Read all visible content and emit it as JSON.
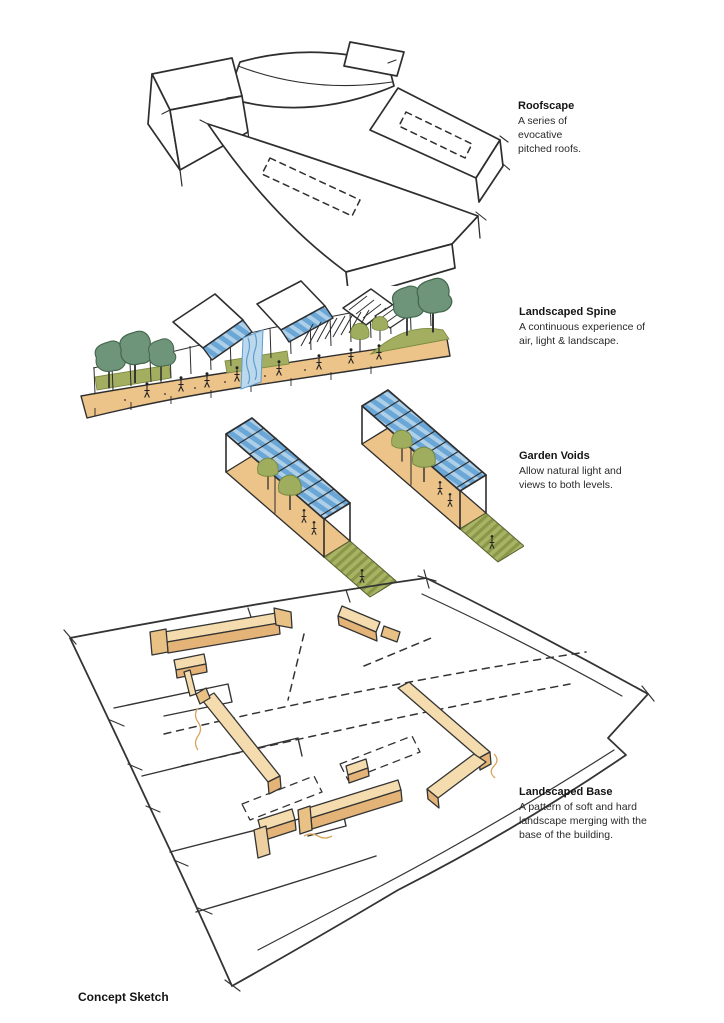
{
  "page": {
    "background": "#ffffff",
    "caption": "Concept Sketch"
  },
  "annotations": [
    {
      "id": "roofscape",
      "title": "Roofscape",
      "description": "A series of evocative pitched roofs."
    },
    {
      "id": "landscaped-spine",
      "title": "Landscaped Spine",
      "description": "A continuous experience of air, light & landscape."
    },
    {
      "id": "garden-voids",
      "title": "Garden Voids",
      "description": "Allow natural light and views to both levels."
    },
    {
      "id": "landscaped-base",
      "title": "Landscaped Base",
      "description": "A pattern of soft and hard landscape merging with the base of the building."
    }
  ],
  "palette": {
    "ink": "#303030",
    "tan": "#ecc389",
    "tan_light": "#f4dcae",
    "tan_dark": "#e4b377",
    "olive": "#a4ae60",
    "tree_green": "#6e9579",
    "glass_blue": "#6aa6d6",
    "glass_blue_light": "#aecfe8"
  }
}
